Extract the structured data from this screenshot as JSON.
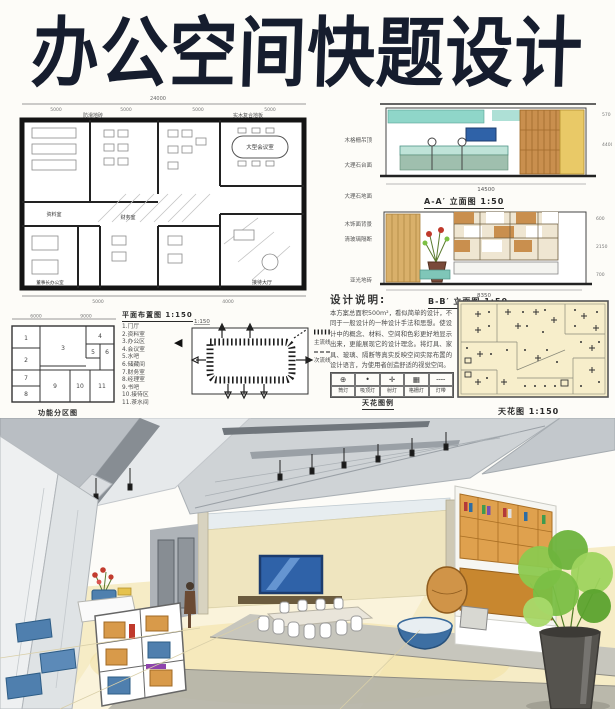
{
  "title": "办公空间快题设计",
  "floor_plan": {
    "caption": "平面布置图 1:150",
    "dim_total": "24000",
    "dims_top": [
      "5000",
      "5000",
      "5000",
      "5000"
    ],
    "dims_bottom": [
      "5000",
      "4000"
    ],
    "note_left": "防滑地砖",
    "note_right": "实木复合地板",
    "rooms": {
      "meeting": "大型会议室",
      "archive": "资料室",
      "finance": "财务室",
      "chairman": "董事长办公室",
      "lobby": "接待大厅"
    }
  },
  "elevation_a": {
    "caption": "A-A′ 立面图 1:50",
    "dim_bottom": "14500",
    "dims_right": [
      "570",
      "4400"
    ],
    "notes": [
      "木格栅吊顶",
      "大理石台面",
      "大理石地面"
    ]
  },
  "elevation_b": {
    "caption": "B-B′ 立面图 1:50",
    "dim_bottom": "8350",
    "dims_right": [
      "600",
      "2150",
      "700"
    ],
    "notes": [
      "木饰面背景",
      "清玻璃隔断",
      "亚光地砖"
    ]
  },
  "zoning": {
    "caption": "功能分区图",
    "dims_top": [
      "6000",
      "9000"
    ],
    "cells": [
      "1",
      "2",
      "3",
      "4",
      "5",
      "6",
      "7",
      "8",
      "9",
      "10",
      "11"
    ]
  },
  "room_legend": {
    "header": "平面布置图 1:150",
    "items": [
      "1.门厅",
      "2.资料室",
      "3.办公区",
      "4.会议室",
      "5.水吧",
      "6.储藏间",
      "7.财务室",
      "8.经理室",
      "9.书吧",
      "10.接待区",
      "11.茶水间"
    ],
    "marker": "◀"
  },
  "circulation": {
    "scale": "1:150",
    "legend_main": "主流线",
    "legend_sub": "次流线"
  },
  "design_notes": {
    "heading": "设计说明:",
    "body": "本方案总面积500m²，看似简单的设计，不同于一般设计的一种设计手法和思想。使设计中的概念、材料、空间和色彩更好地显示出来，更能展现它的设计理念。将灯具、家具、玻璃、隔断等真实反映空间实际布置的设计语言，为使用者创造舒适的视觉空间。"
  },
  "ceiling_legend": {
    "caption": "天花图例",
    "symbols": [
      "⊕",
      "•",
      "✛",
      "▦",
      "╌╌"
    ],
    "labels": [
      "筒灯",
      "吸顶灯",
      "射灯",
      "格栅灯",
      "灯带"
    ]
  },
  "ceiling_plan": {
    "caption": "天花图 1:150"
  },
  "colors": {
    "ink": "#161d2e",
    "wood": "#d79a4e",
    "teal": "#8fd6c9",
    "screen_blue": "#2f62a8",
    "plant_green": "#7cc043",
    "floor_cream": "#f6ecc6",
    "ceiling_gray": "#c2c7cb"
  }
}
